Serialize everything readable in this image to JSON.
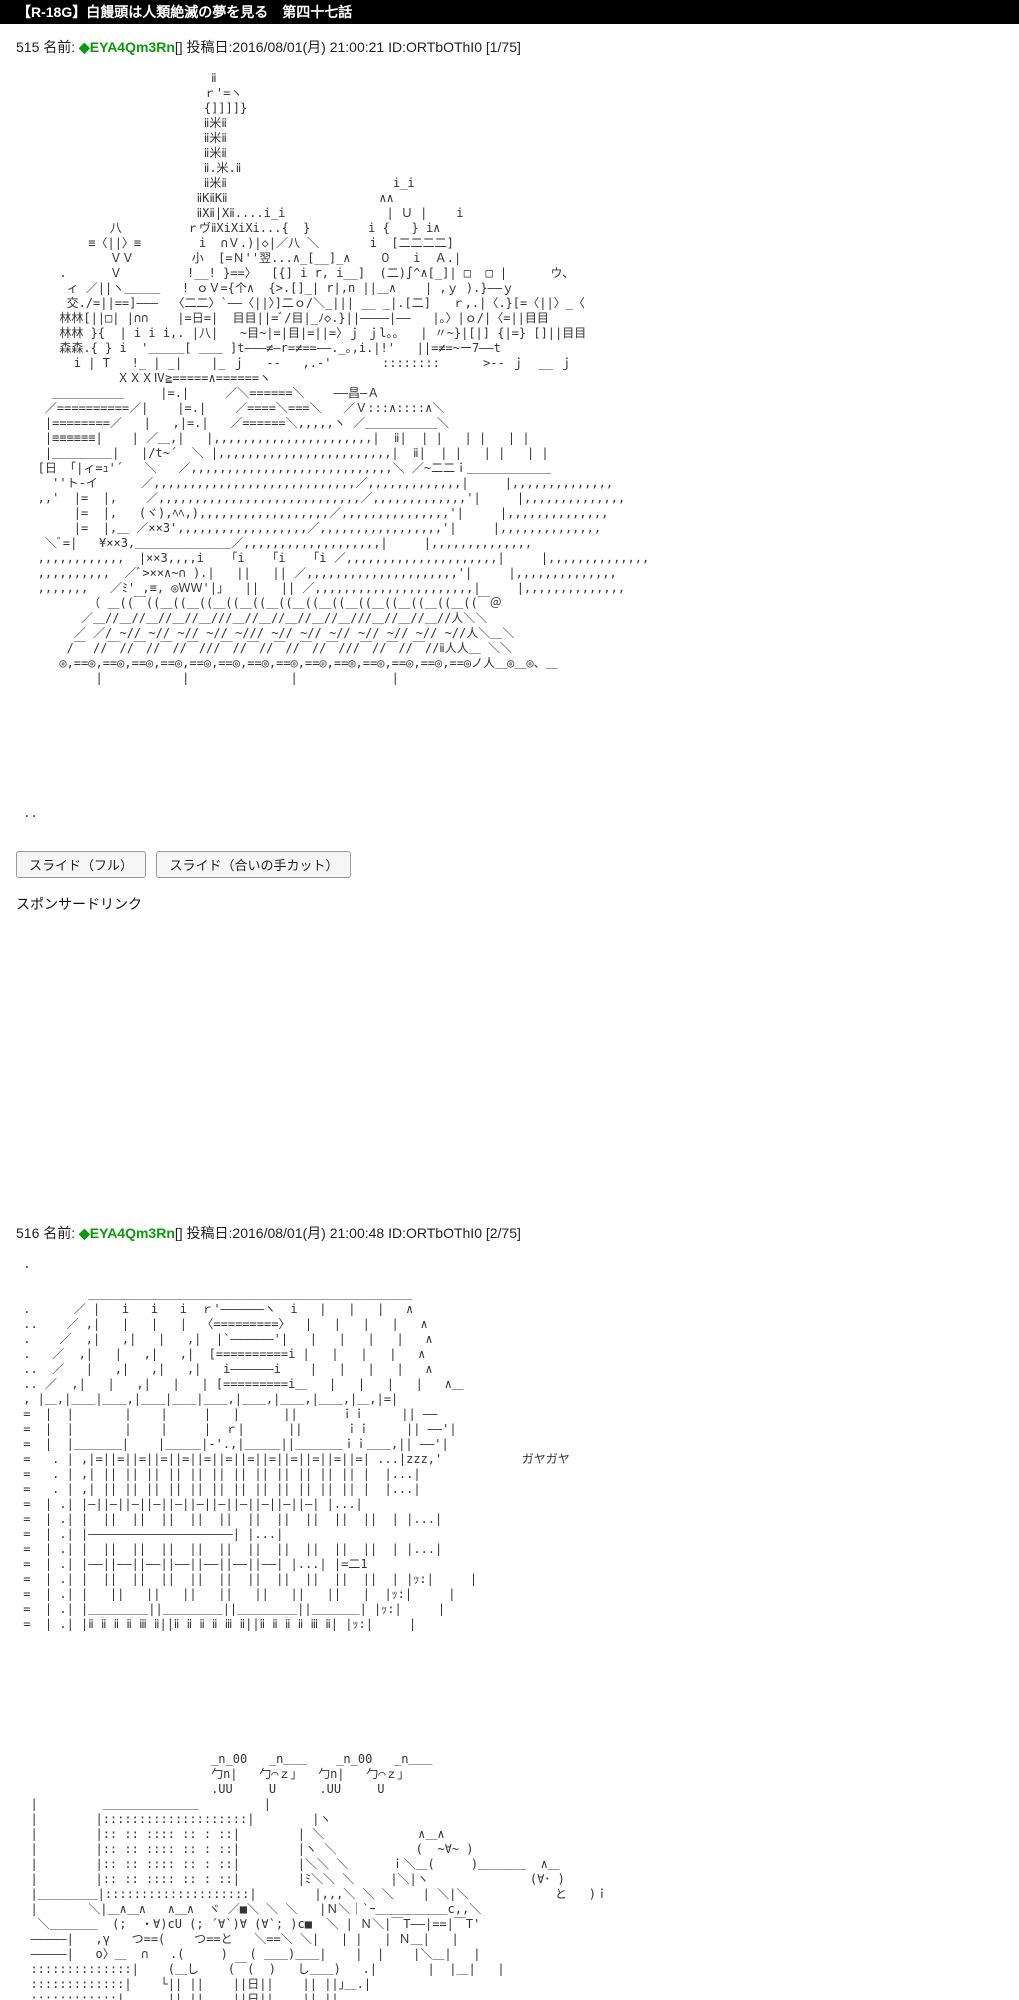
{
  "title_bar": {
    "text": "【R-18G】白饅頭は人類絶滅の夢を見る　第四十七話",
    "bg": "#000000",
    "fg": "#ffffff"
  },
  "buttons": [
    {
      "label": "スライド（フル）"
    },
    {
      "label": "スライド（合いの手カット）"
    }
  ],
  "sponsored": "スポンサードリンク",
  "name_color": "#0a9a0a",
  "posts": [
    {
      "number": "515",
      "name_label": "名前:",
      "name": "◆EYA4Qm3Rn",
      "meta": "[] 投稿日:2016/08/01(月) 21:00:21 ID:ORTbOThI0 [1/75]",
      "aa": [
        "                           ⅱ",
        "                          ｒ'=ヽ",
        "                          {]]]]}",
        "                          ⅱ米ⅱ",
        "                          ⅱ米ⅱ",
        "                          ⅱ米ⅱ",
        "                          ⅱ.米.ⅱ",
        "                          ⅱ米ⅱ                       i_i",
        "                         ⅱΚⅱΚⅱ                     ∧∧",
        "                         ⅱХⅱ|Хⅱ....i_i              | Ｕ |    i",
        "             八         ｒヴⅱХiХiХi...{  }        i {   } i∧",
        "          ≡〈||〉≡        i  ∩Ｖ.)|◇|／八 ＼       i  [二二二二]",
        "             ＶＶ        小  [=Ｎ''翌...∧_[__]_∧    ０   i  Ａ.|",
        "      .      Ｖ         !__! }==〉  [{] i r, i__]  (二)∫^∧[_]| □  □ |      ウ、",
        "       ィ ／||ヽ＿＿＿   ! ｏＶ={个∧  {>.[]_| r|,n ||＿∧    | ,ｙ ).}――ｙ",
        "       交./=||==]―――  〈二二〉`――〈||〉]二ｏ/＼_||| __ _|.[二]   ｒ,.|〈.}[=〈||〉_〈",
        "      林林[||□| |∩∩    |=日=|  目目||=ﾞ/目|_ﾉ◇.}||――――|――   |｡〉|ｏ/|〈=||目目",
        "      林林 }{  | i i i,. |八|   ~目~|=|目|=||=〉ｊ ｊl｡｡   | 〃~}|[|] {|=} []||目目",
        "      森森.{ } i  '＿＿＿[ ＿＿ ]t―――≠―r=≠==――._｡,i.|!'   ||=≠=~ー7――t",
        "        i | T   !_ | _|    |_ ｊ   --   ,.-'       ::::::::      >-- ｊ  __ ｊ",
        "              ＸＸＸⅣ≧=====∧======ヽ",
        "     ＿＿＿＿＿＿     |=.|     ／＼======＼    ――昌―Ａ",
        "    ／==========／|    |=.|    ／====＼===＼   ／Ｖ:::∧::::∧＼",
        "    |========／   |   ,|=.|   ／======＼,,,,,ヽ ／＿＿＿＿＿＿＼",
        "    |≡≡≡≡≡≡|    | ／＿,|   |,,,,,,,,,,,,,,,,,,,,,,|  ⅱ|  | |   | |   | |",
        "    |＿＿＿＿＿|   |/t~´  ＼ |,,,,,,,,,,,,,,,,,,,,,,,,|  ⅱ|  | |   | |   | |",
        "   [日 「|ィ=ｭ'´   ＼   ／,,,,,,,,,,,,,,,,,,,,,,,,,,,,＼ ／~二二ｉ＿＿＿＿＿＿＿",
        "     ''ト-イ      ／,,,,,,,,,,,,,,,,,,,,,,,,,,,,／,,,,,,,,,,,,,|     |,,,,,,,,,,,,,,",
        "   ,,'  |=  |,    ／,,,,,,,,,,,,,,,,,,,,,,,,,,,,／,,,,,,,,,,,,,'|     |,,,,,,,,,,,,,,",
        "        |=  |,   (ヾ),ﾍﾍ,),,,,,,,,,,,,,,,,,,／,,,,,,,,,,,,,,,'|     |,,,,,,,,,,,,,,",
        "        |=  |,＿ ／××3',,,,,,,,,,,,,,,,,,／,,,,,,,,,,,,,,,,,'|     |,,,,,,,,,,,,,,",
        "    ＼ﾞ=|   ¥××3,＿＿＿＿＿＿＿＿／,,,,,,,,,,,,,,,,,,,|     |,,,,,,,,,,,,,,",
        "   ,,,,,,,,,,,,  |××3,,,,i   「i   「i   「i ／,,,,,,,,,,,,,,,,,,,,,|     |,,,,,,,,,,,,,,",
        "   ,,,,,,,,,,  ／ﾞ>××∧~∩ ).|   ||   || ／,,,,,,,,,,,,,,,,,,,,,'|     |,,,,,,,,,,,,,,",
        "   ,,,,,,,   ／ﾐ' ,≡, ◎ＷＷ'|｣   ||   || ／,,,,,,,,,,,,,,,,,,,,,,|     |,,,,,,,,,,,,,,",
        "          （ ＿((￣((＿((＿((＿((＿((＿((＿((＿((＿((＿((＿((＿((＿((￣＠",
        "         ／＿//＿//＿//＿//＿///＿//＿//＿//＿//＿///＿//＿//＿//人＼＼",
        "        ／ ／/ ~// ~// ~// ~// ~/// ~// ~// ~// ~// ~// ~// ~//人＼＿＼",
        "       /￣ //￣//￣//￣//￣///￣//￣//￣//￣//￣///￣//￣//￣//ⅱ人人＿ ＼＼",
        "      ◎,==◎,==◎,==◎,==◎,==◎,==◎,==◎,==◎,==◎,==◎,==◎,==◎,==◎,==◎ノ人＿◎＿◎、＿",
        "           |           |              |             |",
        "",
        "",
        "",
        "",
        "",
        "",
        "",
        "",
        " .."
      ]
    },
    {
      "number": "516",
      "name_label": "名前:",
      "name": "◆EYA4Qm3Rn",
      "meta": "[] 投稿日:2016/08/01(月) 21:00:48 ID:ORTbOThI0 [2/75]",
      "aa": [
        " .",
        "",
        "          ＿＿＿＿＿＿＿＿＿＿＿＿＿＿＿＿＿＿＿＿＿＿＿＿＿＿＿",
        " .      ／ |   i   i   i  ｒ'――――――ヽ  i   |   |   |   ∧",
        " ..    ／ ,|   |   |   |  〈=========〉  |   |   |   |   ∧",
        " .    ／  ,|   ,|   |   ,|  |`――――――'|   |   |   |   |   ∧",
        " .   ／  ,|   |   ,|   ,|  [==========i |   |   |   |   ∧",
        " ..  ／   |   ,|   ,|   ,|   i――――――i    |   |   |   |   ∧",
        " .. ／  ,|   |   ,|   |   | [=========i＿   |   |   |   |   ∧＿",
        " , |＿,|＿＿|＿＿,|＿＿|＿＿|＿＿,|＿＿,|＿＿,|＿＿,|＿,|=|",
        " =  |  |       |    |     |   |      ||      ｉｉ     || ――",
        " =  |  |       |    |     |  ｒ|      ||      ｉｉ     || ――'|",
        " =  |  |＿＿＿＿|    |＿＿＿|-'.,|＿＿＿||＿＿＿＿ｉｉ＿＿,|| ――'|",
        " =   . | ,|=||=||=||=||=||=||=||=||=||=||=||=||=| ...|zzz,'           ガヤガヤ",
        " =   . | ,| || || || || || || || || || || || || |  |...|",
        " =   . | ,| || || || || || || || || || || || || |  |...|",
        " =  | .| |―||―||―||―||―||―||―||―||―||―||―| |...|",
        " =  | .| |  ||  ||  ||  ||  ||  ||  ||  ||  ||  ||  | |...|",
        " =  | .| |――――――――――――――――――――| |...|",
        " =  | .| |  ||  ||  ||  ||  ||  ||  ||  ||  ||  ||  | |...|",
        " =  | .| |――||――||――||――||――||――||――| |...| |=二1",
        " =  | .| |  ||  ||  ||  ||  ||  ||  ||  ||  ||  ||  | |ｯ:|     |",
        " =  | .| |   ||   ||   ||   ||   ||   ||   ||   |  |ｯ:|     |",
        " =  | .| |＿＿＿＿＿||＿＿＿＿＿||＿＿＿＿＿||＿＿＿＿| |ｯ:|     |",
        " =  | .| |ⅱ ⅱ ⅱ ⅱ ⅲ ⅱ||ⅱ ⅱ ⅱ ⅱ ⅲ ⅱ||ⅱ ⅱ ⅱ ⅱ ⅲ ⅱ| |ｯ:|     |",
        "",
        "",
        "",
        "",
        "",
        "",
        "",
        "",
        "                           _n_00   _n＿＿    _n_00   _n＿＿",
        "                           勹n|   勹⌒ｚ｣   勹n|   勹⌒ｚ｣",
        "                           .UU     U      .UU     U",
        "  |         ＿＿＿＿＿＿＿＿         |",
        "  |        |::::::::::::::::::::|        |ヽ",
        "  |        |:: :: :::: :: : ::|        | ＼             ∧＿∧",
        "  |        |:: :: :::: :: : ::|        |ヽ ＼           (  ~∀~ )",
        "  |        |:: :: :::: :: : ::|        |＼＼ ＼      ｉ＼＿(     )＿＿＿＿  ∧＿",
        "  |        |:: :: :::: :: : ::|        |ﾐ＼＼ ＼     |＼|ヽ              (∀･ )",
        "  |＿＿＿＿＿|::::::::::::::::::::|        |,,,＼ ＼ ＼    | ＼|＼            と   )ｉ",
        "  |       ＼|＿∧＿∧   ∧＿∧  ヾ ／■＼ ＼ ＼   |Ｎ＼｜`ｰ＿＿＿＿＿＿c,,＼",
        "   ＼＿＿＿＿  (;  ・∀)cU (; ´∀`)∀ (∀`; )c■  ＼ | Ｎ＼|￣T――|==|￣T'",
        "  ―――――|   ,γ   つ==(    つ==と   ＼==＼ ＼|   | |   | Ｎ＿|   |",
        "  ―――――|   o〉＿  ∩   .(     )   ( ＿＿)＿＿|    |  |    |＼＿|   |",
        "  ::::::::::::::|    (＿し    (￣(  )   し＿＿)   .|       |  |＿|   |",
        "  :::::::::::::|    └|| ||    ||日||    || ||｣＿.|",
        "  ::::::::::::|    ..|| ||    ||日||    || ||."
      ]
    }
  ]
}
